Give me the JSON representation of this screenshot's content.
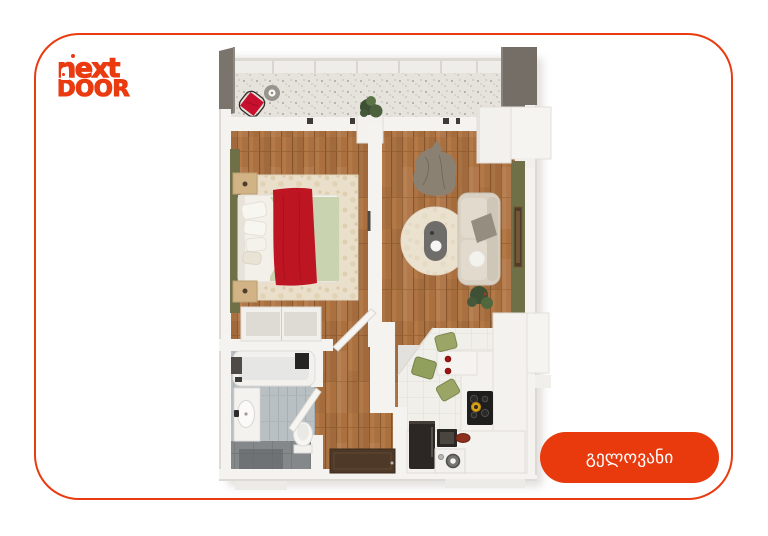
{
  "window": {
    "width_px": 768,
    "height_px": 536,
    "background": "#FFFFFF"
  },
  "card": {
    "background": "#FFFFFF",
    "border_color": "#E93A10",
    "corner_radius_px": 45
  },
  "brand": {
    "line1": "next",
    "line2": "DOOR",
    "color": "#E93A10"
  },
  "cta_button": {
    "label": "გელოვანი",
    "background": "#E93A0E",
    "text_color": "#FFFFFF"
  },
  "floor_plan": {
    "type": "apartment-3d-top-down-render",
    "rooms": [
      {
        "id": "balcony",
        "position": "top",
        "furniture": [
          "wire-chair-red-cushion",
          "round-side-table",
          "potted-plant",
          "low-cabinet"
        ]
      },
      {
        "id": "bedroom",
        "position": "left",
        "furniture": [
          "double-bed",
          "red-blanket",
          "green-duvet",
          "area-rug",
          "nightstand-top",
          "nightstand-bottom",
          "wardrobe"
        ]
      },
      {
        "id": "living-room",
        "position": "right",
        "furniture": [
          "sofa",
          "gray-throw",
          "round-rug",
          "oval-coffee-table",
          "lounge-chair",
          "plant",
          "tall-white-cabinet",
          "wall-mirror"
        ]
      },
      {
        "id": "kitchen",
        "position": "bottom-right",
        "furniture": [
          "peninsula-counter",
          "green-dining-chairs",
          "cooktop",
          "gold-pot",
          "fridge",
          "oven-box",
          "washing-machine",
          "red-bowl"
        ]
      },
      {
        "id": "bathroom",
        "position": "bottom-left",
        "furniture": [
          "bathtub",
          "shower-fixture",
          "vanity-sink",
          "toilet",
          "wall-cabinet"
        ]
      },
      {
        "id": "hallway",
        "position": "bottom-center",
        "furniture": [
          "entry-mat"
        ]
      }
    ],
    "palette": {
      "wood_floor": "#AB7040",
      "wood_line": "#8C5A30",
      "wall_white": "#F5F3F0",
      "wall_shadow": "#DDDAD5",
      "balcony_floor": "#E6E3DD",
      "balcony_speckle": "#A8A49D",
      "dark_wall": "#756E67",
      "accent_olive": "#6F7048",
      "rug_cream": "#EADFCB",
      "bed_red": "#BE1522",
      "duvet_green": "#C9D3AF",
      "sofa_beige": "#D9D2C4",
      "kitchen_tile": "#F1EFEA",
      "bath_tile": "#B9C0C3",
      "bath_tile_dark": "#84888A",
      "chair_green": "#9AA566",
      "appliance_dark": "#2C2724",
      "entry_mat_brown": "#4E3827",
      "stove_gold": "#D7A31C",
      "cushion_red": "#C8102E"
    }
  }
}
